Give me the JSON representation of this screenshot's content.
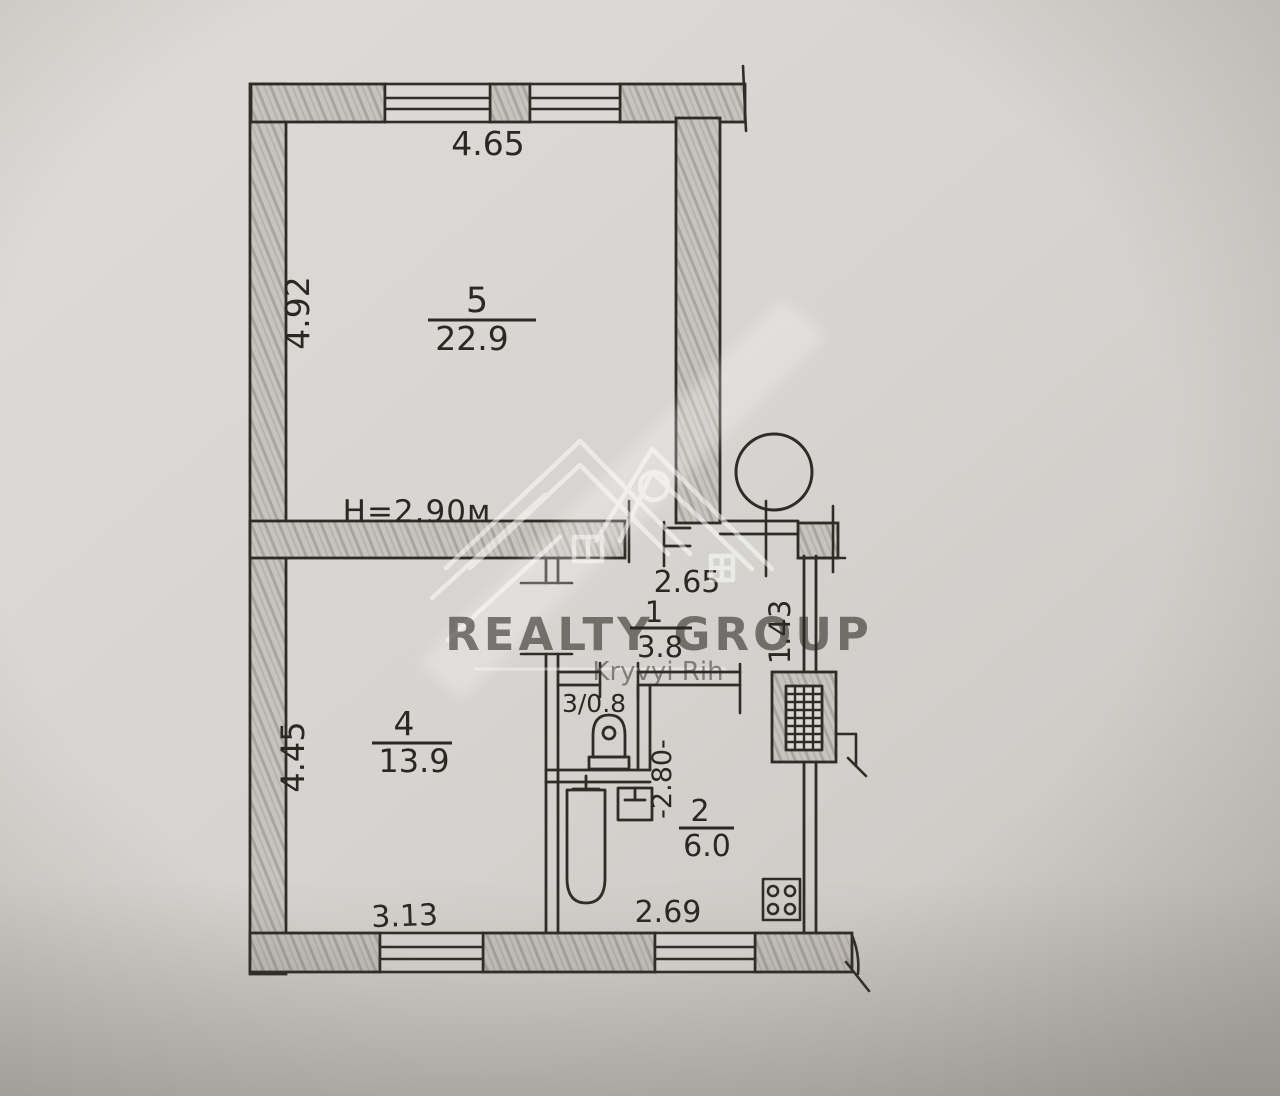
{
  "plan": {
    "ceiling_height": "H=2.90м",
    "rooms": {
      "room5": {
        "number": "5",
        "area": "22.9"
      },
      "room4": {
        "number": "4",
        "area": "13.9"
      },
      "hall": {
        "number": "1",
        "area": "3.8"
      },
      "kitchen": {
        "number": "2",
        "area": "6.0"
      },
      "wc": {
        "label": "3/0.8"
      }
    },
    "dimensions": {
      "room5_width": "4.65",
      "room5_depth": "4.92",
      "hall_width": "2.65",
      "entry_side": "1.43",
      "room4_depth": "4.45",
      "room4_width": "3.13",
      "kitchen_depth": "-2.80-",
      "kitchen_width": "2.69"
    }
  },
  "watermark": {
    "brand": "REALTY GROUP",
    "city": "Kryvyi Rih"
  }
}
